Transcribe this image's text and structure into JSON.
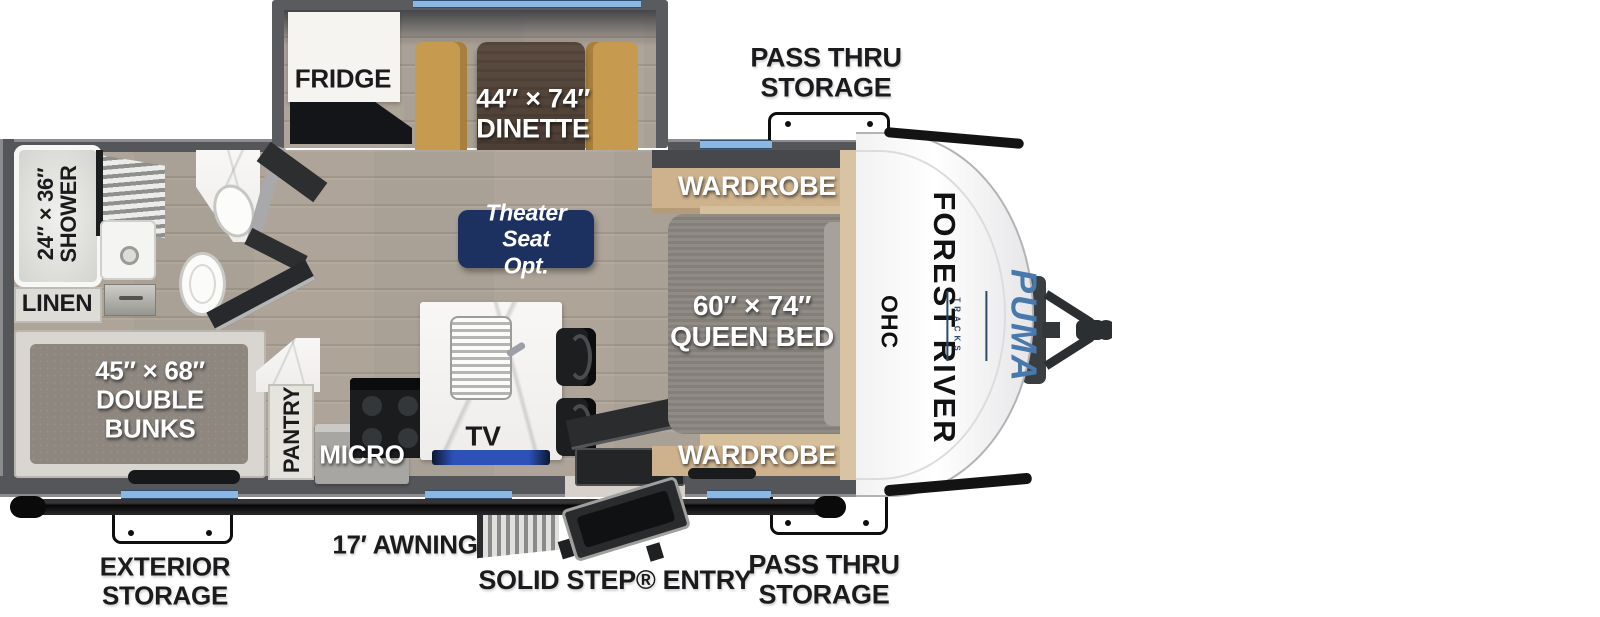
{
  "colors": {
    "badge_navy": "#1d3161",
    "puma_blue": "#4878ac",
    "window_blue": "#8ab7e3",
    "wall_gray": "#57585b",
    "floor_wood": "#b3aba0",
    "bench_tan": "#c79b4f",
    "table_brown": "#4f4238",
    "mattress_gray": "#8b8680",
    "cabinet_tan": "#cdb28d",
    "awning_black": "#0a0a0b"
  },
  "exterior": {
    "pass_thru_top": "PASS THRU\nSTORAGE",
    "pass_thru_bottom": "PASS THRU\nSTORAGE",
    "exterior_storage": "EXTERIOR\nSTORAGE",
    "awning": "17′ AWNING",
    "entry": "SOLID STEP® ENTRY"
  },
  "interior": {
    "fridge": "FRIDGE",
    "dinette": "44″ × 74″\nDINETTE",
    "wardrobe_top": "WARDROBE",
    "wardrobe_bottom": "WARDROBE",
    "theater_seat": "Theater Seat\nOpt.",
    "queen_bed": "60″ × 74″\nQUEEN BED",
    "ohc": "OHC",
    "shower": "24″ × 36″\nSHOWER",
    "linen": "LINEN",
    "double_bunks": "45″ × 68″\nDOUBLE\nBUNKS",
    "pantry": "PANTRY",
    "micro": "MICRO",
    "tv": "TV"
  },
  "brand": {
    "manufacturer": "FOREST RIVER",
    "model": "PUMA",
    "series": "TRACKS"
  }
}
